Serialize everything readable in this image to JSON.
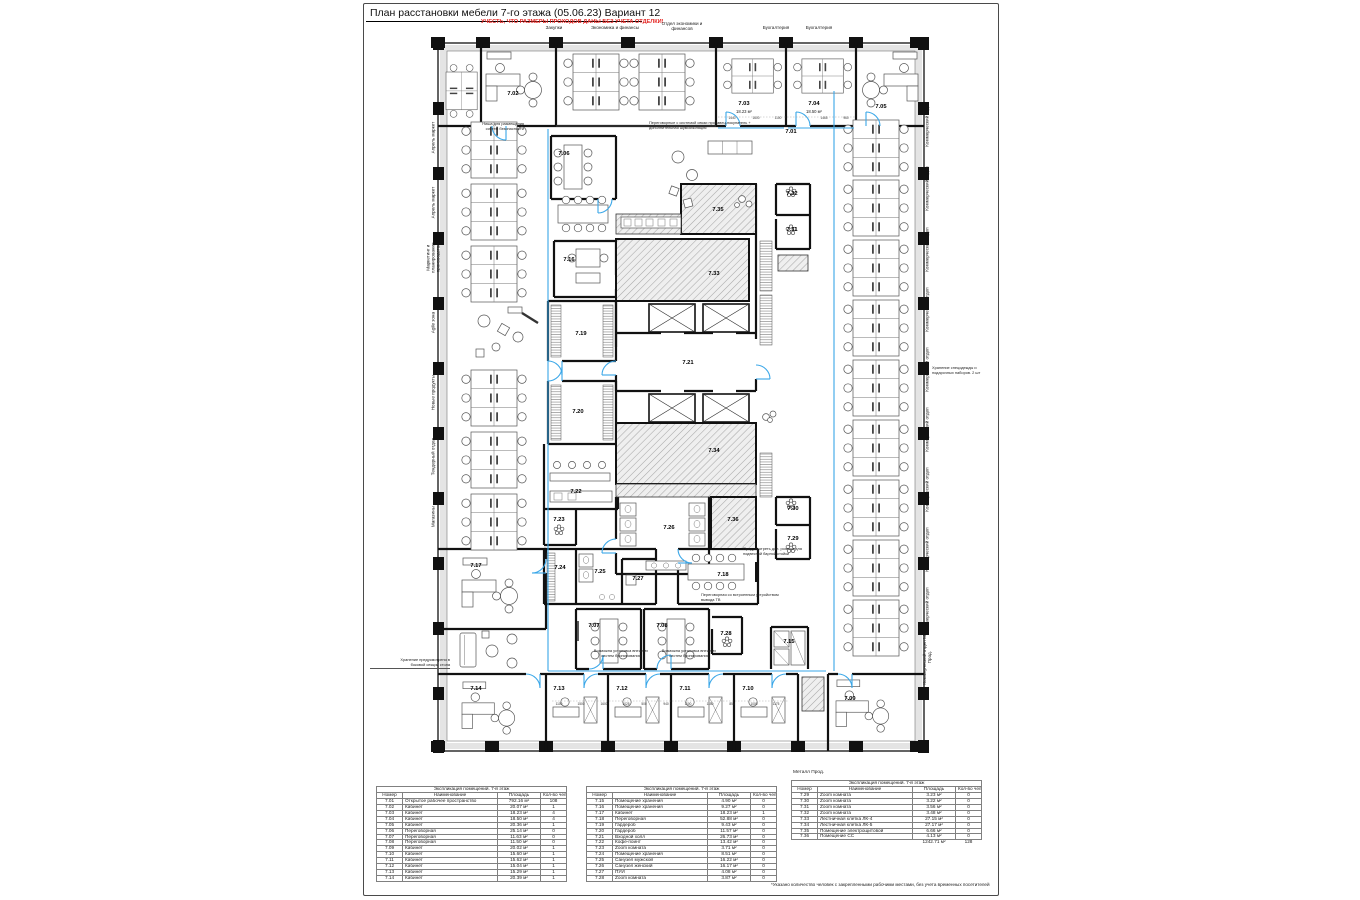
{
  "title": "План расстановки мебели 7-го этажа (05.06.23) Вариант 12",
  "warning": "УЧЕСТЬ, ЧТО РАЗМЕРЫ ПРОХОДОВ ДАНЫ БЕЗ УЧЕТА ОТДЕЛКИ!",
  "colors": {
    "wall": "#111111",
    "door_accent": "#3aa7e8",
    "warning_red": "#e52421",
    "hatch_fill": "#efefef"
  },
  "top_labels": [
    "Закупки",
    "Экономика и финансы",
    "Отдел экономики и финансов",
    "Бухгалтерия",
    "Бухгалтерия"
  ],
  "left_labels": [
    "Апрель маркет",
    "Апрель маркет",
    "Маркетинг и планирование производства",
    "Agile зона",
    "Новые продукты",
    "Тендерный отдел",
    "Магазины"
  ],
  "right_labels": [
    "Коммерческий отдел",
    "Коммерческий отдел",
    "Коммерческий отдел",
    "Коммерческий отдел",
    "Коммерческий отдел",
    "Коммерческий отдел",
    "Коммерческий отдел",
    "Коммерческий отдел",
    "Коммерческий отдел",
    "Коммерческий отдел Мет. Прод."
  ],
  "metall_label": "Металл Прод.",
  "footnote": "*Указано количество человек с закрепленными рабочими местами, без учета временных посетителей",
  "plan": {
    "rooms": [
      {
        "n": "7.01",
        "x": 365,
        "y": 104,
        "s": 8
      },
      {
        "n": "7.02",
        "x": 87,
        "y": 66
      },
      {
        "n": "7.03",
        "x": 318,
        "y": 76
      },
      {
        "n": "7.04",
        "x": 388,
        "y": 76
      },
      {
        "n": "7.05",
        "x": 455,
        "y": 79
      },
      {
        "n": "7.06",
        "x": 138,
        "y": 126
      },
      {
        "n": "7.07",
        "x": 168,
        "y": 598
      },
      {
        "n": "7.08",
        "x": 236,
        "y": 598
      },
      {
        "n": "7.09",
        "x": 424,
        "y": 671
      },
      {
        "n": "7.10",
        "x": 322,
        "y": 661
      },
      {
        "n": "7.11",
        "x": 259,
        "y": 661
      },
      {
        "n": "7.12",
        "x": 196,
        "y": 661
      },
      {
        "n": "7.13",
        "x": 133,
        "y": 661
      },
      {
        "n": "7.14",
        "x": 50,
        "y": 661
      },
      {
        "n": "7.15",
        "x": 363,
        "y": 614
      },
      {
        "n": "7.16",
        "x": 143,
        "y": 232
      },
      {
        "n": "7.17",
        "x": 50,
        "y": 538
      },
      {
        "n": "7.18",
        "x": 297,
        "y": 547
      },
      {
        "n": "7.19",
        "x": 155,
        "y": 306
      },
      {
        "n": "7.20",
        "x": 152,
        "y": 384
      },
      {
        "n": "7.21",
        "x": 262,
        "y": 335
      },
      {
        "n": "7.22",
        "x": 150,
        "y": 464
      },
      {
        "n": "7.23",
        "x": 133,
        "y": 492
      },
      {
        "n": "7.24",
        "x": 134,
        "y": 540
      },
      {
        "n": "7.25",
        "x": 174,
        "y": 544
      },
      {
        "n": "7.26",
        "x": 243,
        "y": 500
      },
      {
        "n": "7.27",
        "x": 212,
        "y": 551
      },
      {
        "n": "7.28",
        "x": 300,
        "y": 606
      },
      {
        "n": "7.29",
        "x": 367,
        "y": 511
      },
      {
        "n": "7.30",
        "x": 367,
        "y": 481
      },
      {
        "n": "7.31",
        "x": 366,
        "y": 202
      },
      {
        "n": "7.32",
        "x": 366,
        "y": 166
      },
      {
        "n": "7.33",
        "x": 288,
        "y": 246
      },
      {
        "n": "7.34",
        "x": 288,
        "y": 423
      },
      {
        "n": "7.35",
        "x": 292,
        "y": 182
      },
      {
        "n": "7.36",
        "x": 307,
        "y": 492
      }
    ],
    "areas": [
      {
        "t": "18.23 м²",
        "x": 318,
        "y": 84
      },
      {
        "t": "18.50 м²",
        "x": 388,
        "y": 84
      }
    ],
    "dims": [
      {
        "t": "1440",
        "x": 306,
        "y": 90
      },
      {
        "t": "1600",
        "x": 330,
        "y": 90
      },
      {
        "t": "1100",
        "x": 352,
        "y": 90
      },
      {
        "t": "1465",
        "x": 398,
        "y": 90
      },
      {
        "t": "960",
        "x": 420,
        "y": 90
      },
      {
        "t": "1100",
        "x": 133,
        "y": 676
      },
      {
        "t": "1500",
        "x": 155,
        "y": 676
      },
      {
        "t": "1600",
        "x": 178,
        "y": 676
      },
      {
        "t": "1025",
        "x": 200,
        "y": 676
      },
      {
        "t": "500",
        "x": 218,
        "y": 676
      },
      {
        "t": "940",
        "x": 240,
        "y": 676
      },
      {
        "t": "1100",
        "x": 262,
        "y": 676
      },
      {
        "t": "1150",
        "x": 284,
        "y": 676
      },
      {
        "t": "850",
        "x": 306,
        "y": 676
      },
      {
        "t": "1000",
        "x": 328,
        "y": 676
      },
      {
        "t": "1175",
        "x": 350,
        "y": 676
      }
    ]
  },
  "annotations": [
    {
      "left": 94,
      "top": 118,
      "width": 66,
      "align": "right",
      "ul": false,
      "text": "Ниша для размещения\nсистем безопасности"
    },
    {
      "left": 285,
      "top": 117,
      "width": 150,
      "align": "left",
      "ul": false,
      "text": "Переговорные с системой связи продавец-покупатель +\nдополнительная шумоизоляция"
    },
    {
      "left": 568,
      "top": 362,
      "width": 62,
      "align": "left",
      "ul": false,
      "text": "Хранение спецодежды и\nподарочных наборов. 2 шт"
    },
    {
      "left": 337,
      "top": 589,
      "width": 114,
      "align": "left",
      "ul": false,
      "text": "Переговорная со встроенным устройством\nвывода ТВ"
    },
    {
      "left": 6,
      "top": 654,
      "width": 80,
      "align": "right",
      "ul": true,
      "text": "Хранение предусмотрено в\nбоковой секции стола"
    },
    {
      "left": 225,
      "top": 645,
      "width": 64,
      "align": "center",
      "ul": false,
      "text": "Возможна установка внешних\nсистем бронирования"
    },
    {
      "left": 293,
      "top": 645,
      "width": 64,
      "align": "center",
      "ul": false,
      "text": "Возможна установка внешних\nсистем бронирования"
    },
    {
      "left": 379,
      "top": 543,
      "width": 68,
      "align": "left",
      "ul": false,
      "text": "Предусмотреть доп. розетки для\nподвесной барной стойки"
    }
  ],
  "tables": [
    {
      "title": "Экспликация помещений. 7-й этаж",
      "columns": [
        "Номер",
        "Наименование",
        "Площадь",
        "Кол-во чел.*"
      ],
      "rows": [
        [
          "7.01",
          "Открытое рабочее пространство",
          "792.16 м²",
          "108"
        ],
        [
          "7.02",
          "Кабинет",
          "20.07 м²",
          "1"
        ],
        [
          "7.03",
          "Кабинет",
          "18.23 м²",
          "4"
        ],
        [
          "7.04",
          "Кабинет",
          "18.50 м²",
          "4"
        ],
        [
          "7.05",
          "Кабинет",
          "20.36 м²",
          "1"
        ],
        [
          "7.06",
          "Переговорная",
          "25.14 м²",
          "0"
        ],
        [
          "7.07",
          "Переговорная",
          "11.63 м²",
          "0"
        ],
        [
          "7.08",
          "Переговорная",
          "11.50 м²",
          "0"
        ],
        [
          "7.09",
          "Кабинет",
          "20.02 м²",
          "1"
        ],
        [
          "7.10",
          "Кабинет",
          "15.60 м²",
          "1"
        ],
        [
          "7.11",
          "Кабинет",
          "15.62 м²",
          "1"
        ],
        [
          "7.12",
          "Кабинет",
          "15.04 м²",
          "1"
        ],
        [
          "7.13",
          "Кабинет",
          "15.29 м²",
          "1"
        ],
        [
          "7.14",
          "Кабинет",
          "20.39 м²",
          "1"
        ]
      ]
    },
    {
      "title": "Экспликация помещений. 7-й этаж",
      "columns": [
        "Номер",
        "Наименование",
        "Площадь",
        "Кол-во чел.*"
      ],
      "rows": [
        [
          "7.15",
          "Помещение хранения",
          "4.90 м²",
          "0"
        ],
        [
          "7.16",
          "Помещение хранения",
          "9.27 м²",
          "0"
        ],
        [
          "7.17",
          "Кабинет",
          "18.23 м²",
          "1"
        ],
        [
          "7.18",
          "Переговорная",
          "52.88 м²",
          "0"
        ],
        [
          "7.19",
          "Гардероб",
          "9.43 м²",
          "0"
        ],
        [
          "7.20",
          "Гардероб",
          "11.57 м²",
          "0"
        ],
        [
          "7.21",
          "Входной холл",
          "26.73 м²",
          "0"
        ],
        [
          "7.22",
          "Кофе-поинт",
          "13.42 м²",
          "0"
        ],
        [
          "7.23",
          "Zoom комната",
          "3.71 м²",
          "0"
        ],
        [
          "7.24",
          "Помещение хранения",
          "8.51 м²",
          "0"
        ],
        [
          "7.25",
          "Санузел мужской",
          "16.22 м²",
          "0"
        ],
        [
          "7.26",
          "Санузел женский",
          "16.17 м²",
          "0"
        ],
        [
          "7.27",
          "ПУИ",
          "4.08 м²",
          "0"
        ],
        [
          "7.28",
          "Zoom комната",
          "3.87 м²",
          "0"
        ]
      ]
    },
    {
      "title": "Экспликация помещений. 7-й этаж",
      "columns": [
        "Номер",
        "Наименование",
        "Площадь",
        "Кол-во чел.*"
      ],
      "rows": [
        [
          "7.29",
          "Zoom комната",
          "3.23 м²",
          "0"
        ],
        [
          "7.30",
          "Zoom комната",
          "3.22 м²",
          "0"
        ],
        [
          "7.31",
          "Zoom комната",
          "3.56 м²",
          "0"
        ],
        [
          "7.32",
          "Zoom комната",
          "3.48 м²",
          "0"
        ],
        [
          "7.33",
          "Лестничная клетка ЛК-4",
          "27.15 м²",
          "0"
        ],
        [
          "7.34",
          "Лестничная клетка ЛК-5",
          "27.17 м²",
          "0"
        ],
        [
          "7.35",
          "Помещение электрощитовой",
          "6.66 м²",
          "0"
        ],
        [
          "7.36",
          "Помещение СС",
          "4.13 м²",
          "0"
        ]
      ],
      "total": [
        "",
        "",
        "1242.71 м²",
        "128"
      ]
    }
  ]
}
